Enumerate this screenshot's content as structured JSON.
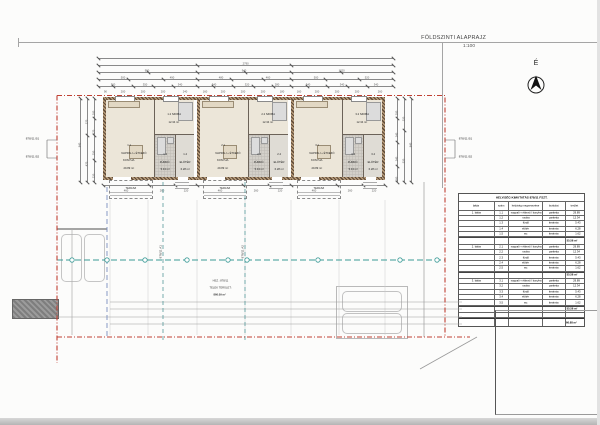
{
  "page": {
    "title": "FÖLDSZINTI ALAPRAJZ",
    "scale": "1:100",
    "north_label": "É"
  },
  "parcel": {
    "left_labels": [
      "878/11 B1",
      "878/11 B2"
    ],
    "right_labels": [
      "878/11 B1",
      "878/11 B2"
    ],
    "axis_labels": [
      "878/11 A1",
      "878/11 A2"
    ],
    "info_lines": [
      "HSZ.: 878/11",
      "TELEK TERÜLET:",
      "866.09 m²"
    ]
  },
  "units": [
    {
      "living_num": "1.1",
      "living_name1": "NAPPALI + ÉTKEZŐ",
      "living_name2": "KONYHA",
      "living_area": "29.89 m²",
      "bedroom_num": "1.2",
      "bedroom_name": "SZOBA",
      "bedroom_area": "12.34 m²",
      "bath_num": "1.3",
      "bath_name": "FÜRDŐ",
      "bath_area": "5.43 m²",
      "hall_num": "1.4",
      "hall_name": "ELŐTÉR",
      "hall_area": "6.28 m²",
      "terrace_label": "TERASZ"
    },
    {
      "living_num": "2.1",
      "living_name1": "NAPPALI + ÉTKEZŐ",
      "living_name2": "KONYHA",
      "living_area": "29.89 m²",
      "bedroom_num": "2.2",
      "bedroom_name": "SZOBA",
      "bedroom_area": "12.34 m²",
      "bath_num": "2.3",
      "bath_name": "FÜRDŐ",
      "bath_area": "5.43 m²",
      "hall_num": "2.4",
      "hall_name": "ELŐTÉR",
      "hall_area": "6.28 m²",
      "terrace_label": "TERASZ"
    },
    {
      "living_num": "3.1",
      "living_name1": "NAPPALI + ÉTKEZŐ",
      "living_name2": "KONYHA",
      "living_area": "29.89 m²",
      "bedroom_num": "3.2",
      "bedroom_name": "SZOBA",
      "bedroom_area": "12.34 m²",
      "bath_num": "3.3",
      "bath_name": "FÜRDŐ",
      "bath_area": "5.43 m²",
      "hall_num": "3.4",
      "hall_name": "ELŐTÉR",
      "hall_area": "6.28 m²",
      "terrace_label": "TERASZ"
    }
  ],
  "table": {
    "title": "HELYISÉG KIMUTATÁS 878/11 FSZT.",
    "headers": [
      "lakás",
      "szám",
      "helyiség megnevezése",
      "burkolat",
      "terület"
    ],
    "groups": [
      {
        "unit": "1. lakás",
        "rows": [
          [
            "1.1",
            "nappali + étkező / konyha",
            "parketta",
            "29.89"
          ],
          [
            "1.2",
            "szoba",
            "parketta",
            "12.34"
          ],
          [
            "1.3",
            "fürdő",
            "kerámia",
            "5.43"
          ],
          [
            "1.4",
            "előtér",
            "kerámia",
            "6.28"
          ],
          [
            "1.5",
            "wc",
            "kerámia",
            "1.62"
          ]
        ],
        "sum": "55.56 m²"
      },
      {
        "unit": "2. lakás",
        "rows": [
          [
            "2.1",
            "nappali + étkező / konyha",
            "parketta",
            "29.89"
          ],
          [
            "2.2",
            "szoba",
            "parketta",
            "12.34"
          ],
          [
            "2.3",
            "fürdő",
            "kerámia",
            "5.43"
          ],
          [
            "2.4",
            "előtér",
            "kerámia",
            "6.28"
          ],
          [
            "2.5",
            "wc",
            "kerámia",
            "1.62"
          ]
        ],
        "sum": "55.56 m²"
      },
      {
        "unit": "3. lakás",
        "rows": [
          [
            "3.1",
            "nappali + étkező / konyha",
            "parketta",
            "29.89"
          ],
          [
            "3.2",
            "szoba",
            "parketta",
            "12.34"
          ],
          [
            "3.3",
            "fürdő",
            "kerámia",
            "5.43"
          ],
          [
            "3.4",
            "előtér",
            "kerámia",
            "6.28"
          ],
          [
            "3.5",
            "wc",
            "kerámia",
            "1.62"
          ]
        ],
        "sum": "55.56 m²"
      }
    ],
    "total": "166.68 m²"
  },
  "dims": {
    "top": [
      {
        "y": 58,
        "ticks": [
          98,
          393
        ],
        "labels": [
          "2790"
        ]
      },
      {
        "y": 65,
        "ticks": [
          98,
          197,
          291,
          393
        ],
        "labels": [
          "990",
          "940",
          "1020"
        ]
      },
      {
        "y": 72,
        "ticks": [
          98,
          148,
          197,
          245,
          291,
          341,
          393
        ],
        "labels": [
          "500",
          "490",
          "480",
          "460",
          "500",
          "520"
        ]
      },
      {
        "y": 79,
        "ticks": [
          98,
          128,
          163,
          197,
          231,
          263,
          291,
          325,
          359,
          393
        ],
        "labels": [
          "300",
          "350",
          "340",
          "340",
          "320",
          "280",
          "340",
          "340",
          "340"
        ]
      },
      {
        "y": 86,
        "ticks": [
          98,
          113,
          133,
          153,
          173,
          197,
          213,
          233,
          253,
          273,
          291,
          307,
          327,
          347,
          367,
          393
        ],
        "labels": [
          "90",
          "200",
          "200",
          "200",
          "240",
          "160",
          "200",
          "200",
          "200",
          "180",
          "160",
          "200",
          "200",
          "200",
          "260"
        ]
      }
    ],
    "left": [
      {
        "x": 80,
        "ticks": [
          98,
          182
        ],
        "labels": [
          "840"
        ]
      },
      {
        "x": 87,
        "ticks": [
          98,
          135,
          182
        ],
        "labels": [
          "370",
          "470"
        ]
      },
      {
        "x": 94,
        "ticks": [
          98,
          118,
          135,
          160,
          182
        ],
        "labels": [
          "200",
          "170",
          "250",
          "220"
        ]
      }
    ],
    "right": [
      {
        "x": 397,
        "ticks": [
          98,
          118,
          142,
          166,
          182
        ],
        "labels": [
          "200",
          "240",
          "240",
          "160"
        ]
      },
      {
        "x": 404,
        "ticks": [
          98,
          130,
          182
        ],
        "labels": [
          "320",
          "520"
        ]
      },
      {
        "x": 411,
        "ticks": [
          98,
          182
        ],
        "labels": [
          "840"
        ]
      }
    ],
    "bottom": [
      {
        "y": 185,
        "ticks": [
          103,
          149,
          175,
          197,
          243,
          269,
          291,
          337,
          363,
          385
        ],
        "labels": [
          "460",
          "260",
          "220",
          "460",
          "260",
          "220",
          "460",
          "260",
          "220"
        ]
      }
    ]
  },
  "site": {
    "utility_circle_xs": [
      72,
      107,
      145,
      187,
      228,
      247,
      318,
      400,
      437
    ],
    "boundary_color": "#c04033",
    "utility_color": "#3a9a96",
    "water_color": "#7a8fc0"
  }
}
